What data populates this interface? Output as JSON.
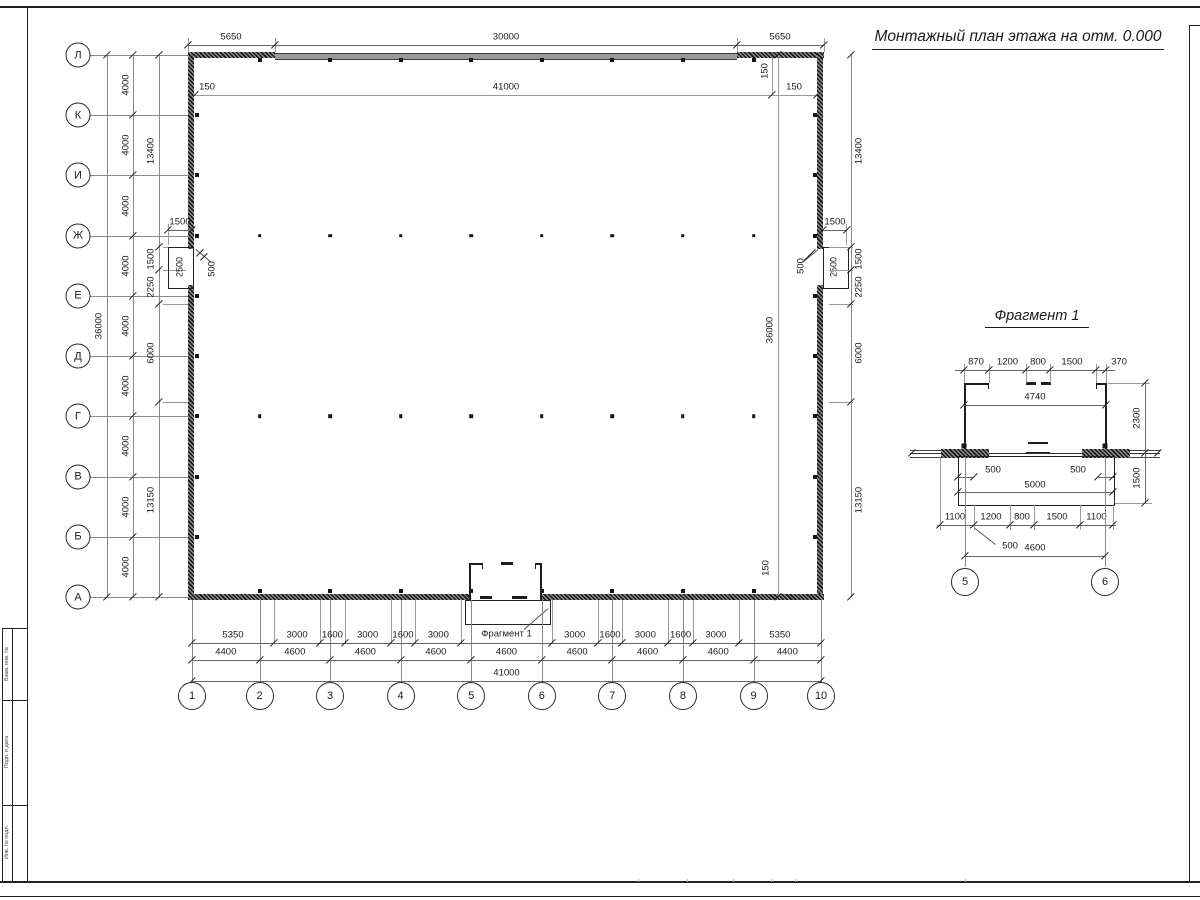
{
  "title": "Монтажный план этажа на отм. 0.000",
  "fragment": {
    "title": "Фрагмент 1",
    "top_chain": [
      "870",
      "1200",
      "800",
      "1500",
      "370"
    ],
    "inner_width": "4740",
    "right_upper": "2300",
    "right_lower": "1500",
    "offset_left": "500",
    "offset_right": "500",
    "porch_width": "5000",
    "bottom_chain": [
      "1100",
      "1200",
      "800",
      "1500",
      "1100"
    ],
    "bottom_offset": "500",
    "axis_span": "4600",
    "axis_circles": [
      "5",
      "6"
    ]
  },
  "axes": {
    "letters": [
      "Л",
      "К",
      "И",
      "Ж",
      "Е",
      "Д",
      "Г",
      "В",
      "Б",
      "А"
    ],
    "numbers": [
      "1",
      "2",
      "3",
      "4",
      "5",
      "6",
      "7",
      "8",
      "9",
      "10"
    ]
  },
  "dims": {
    "top_chain": [
      "5650",
      "30000",
      "5650"
    ],
    "inner_top": [
      "150",
      "41000",
      "150"
    ],
    "corner_offset_top": "150",
    "corner_offset_bottom": "150",
    "left_overall": "36000",
    "right_inner_overall": "36000",
    "spacing_4000": [
      "4000",
      "4000",
      "4000",
      "4000",
      "4000",
      "4000",
      "4000",
      "4000",
      "4000"
    ],
    "side_chain": [
      "13400",
      "1500",
      "2250",
      "6000",
      "13150"
    ],
    "niche_width": "1500",
    "niche_height": "2500",
    "niche_depth": "500",
    "bottom_row1": [
      "5350",
      "3000",
      "1600",
      "3000",
      "1600",
      "3000",
      "3000",
      "1600",
      "3000",
      "1600",
      "3000",
      "5350"
    ],
    "bottom_ref_label": "Фрагмент 1",
    "bottom_row2": [
      "4400",
      "4600",
      "4600",
      "4600",
      "4600",
      "4600",
      "4600",
      "4600",
      "4400"
    ],
    "bottom_total": "41000"
  },
  "stamp": [
    "Взам. инв. №",
    "Подп. и дата",
    "Инв. № подл."
  ]
}
